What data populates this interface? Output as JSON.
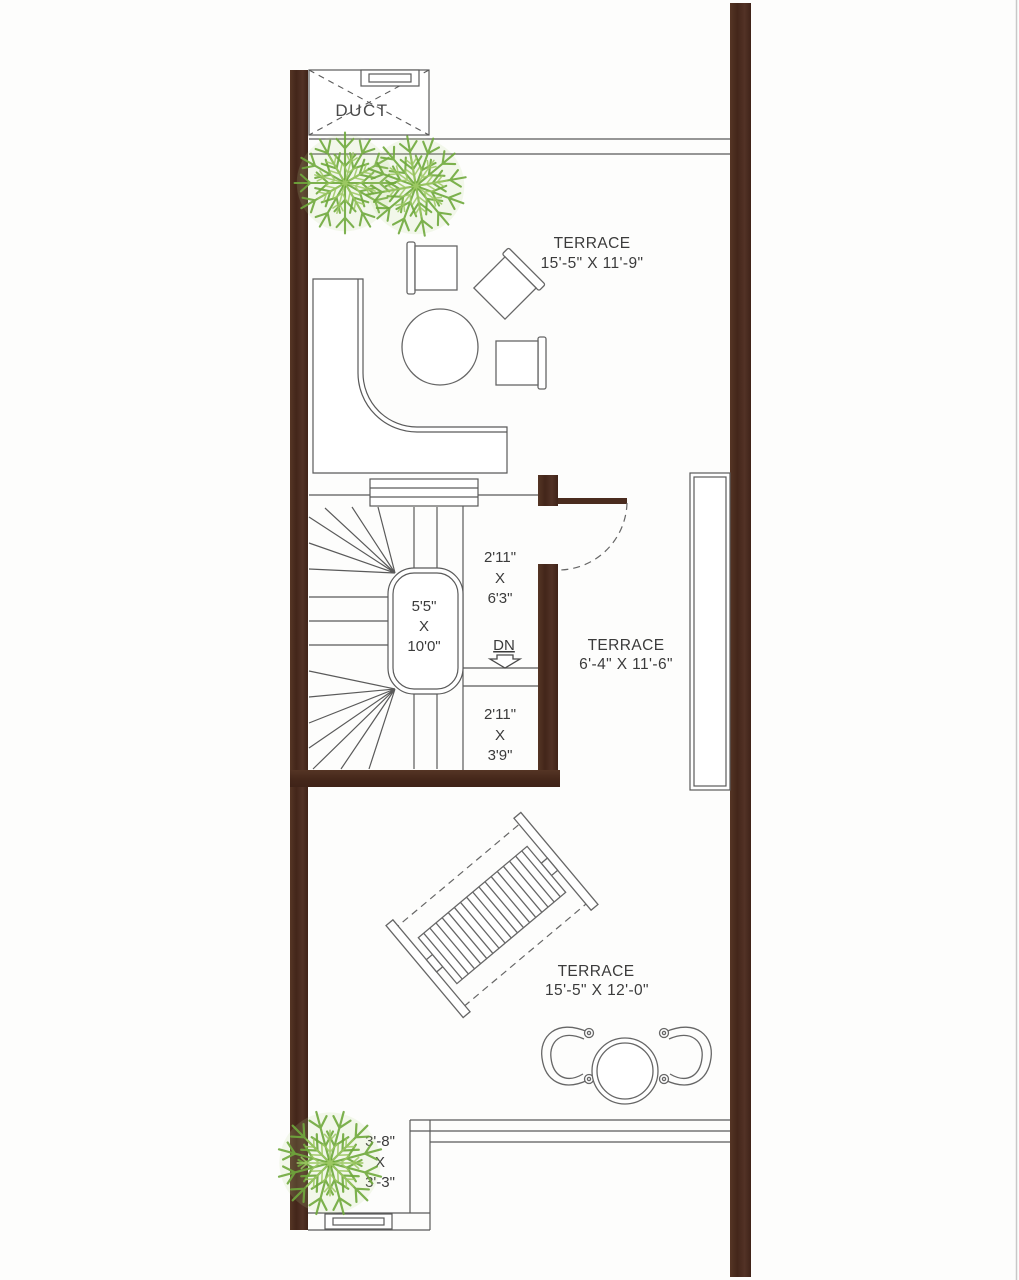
{
  "rooms": {
    "duct": {
      "label": "DUCT"
    },
    "terrace_top": {
      "title": "TERRACE",
      "dims": "15'-5\" X 11'-9\""
    },
    "terrace_mid": {
      "title": "TERRACE",
      "dims": "6'-4\" X 11'-6\""
    },
    "terrace_bottom": {
      "title": "TERRACE",
      "dims": "15'-5\" X 12'-0\""
    },
    "stair_well": {
      "line1": "5'5\"",
      "line2": "X",
      "line3": "10'0\""
    },
    "landing_upper": {
      "line1": "2'11\"",
      "line2": "X",
      "line3": "6'3\""
    },
    "landing_lower": {
      "line1": "2'11\"",
      "line2": "X",
      "line3": "3'9\""
    },
    "corner_nook": {
      "line1": "3'-8\"",
      "line2": "X",
      "line3": "3'-3\""
    }
  },
  "stair": {
    "direction_label": "DN"
  },
  "icons": {
    "down_arrow": "⇩",
    "plant": "✳"
  },
  "colors": {
    "line": "#5a5a5a",
    "furn": "#666666",
    "ink": "#3b3b3b",
    "plant1": "#6fa93c",
    "plant2": "#9cc863",
    "wall": "#4a2c1f",
    "border": "#c8c8c8"
  }
}
